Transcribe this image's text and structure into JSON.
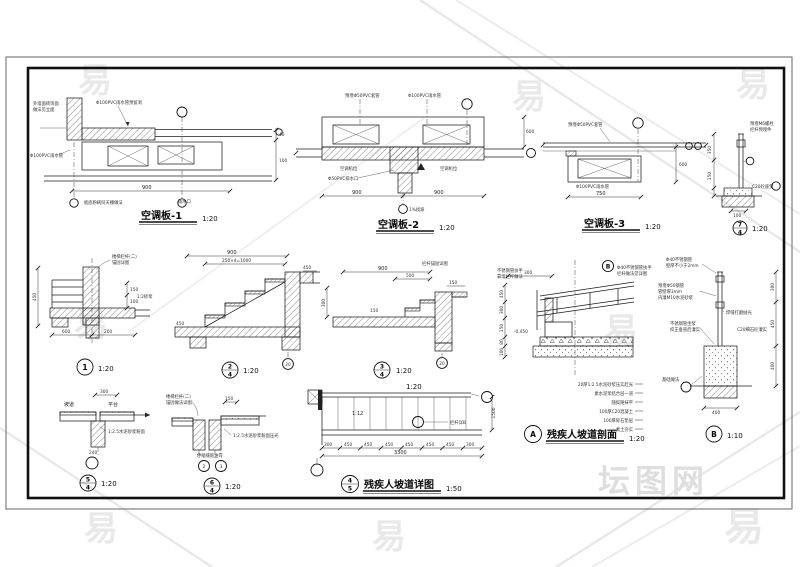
{
  "watermark": {
    "glyph": "易",
    "brand": "坛图网"
  },
  "ac1": {
    "title": "空调板-1",
    "scale": "1:20",
    "dim_total": "900",
    "dim_r1": "40",
    "dim_r2": "100",
    "a_wall1": "外墙面砖饰面",
    "a_wall2": "做法见立面",
    "a_pipe_top": "Φ100PVC雨水管预留洞",
    "a_pipe_left": "Φ100PVC雨水管",
    "a_bottom": "板底粉刷同天棚做法",
    "a_drain": "雨水口"
  },
  "ac2": {
    "title": "空调板-2",
    "scale": "1:20",
    "dim_l": "900",
    "dim_r": "900",
    "dim_side": "600",
    "a_sleeve": "预埋Φ50PVC套管",
    "a_pipe": "Φ100PVC雨水管",
    "a_unit1": "空调机位",
    "a_unit2": "空调机位",
    "a_drain": "Φ50PVC排水口",
    "a_slope": "1%找坡"
  },
  "ac3": {
    "title": "空调板-3",
    "scale": "1:20",
    "dim_total": "750",
    "dim_side": "600",
    "a_sleeve": "预埋Φ50PVC套管",
    "a_pipe": "Φ100PVC雨水管"
  },
  "post": {
    "scale": "1:20",
    "num_top": "7",
    "num_bot": "4",
    "a1": "预埋M6螺栓",
    "a2": "栏杆预埋件",
    "a3": "C20砼座浆",
    "dim1": "350",
    "dim2": "150",
    "dim3": "100"
  },
  "d1": {
    "num": "1",
    "scale": "1:20",
    "a1": "楼梯栏杆(二)",
    "a2": "锚固详图",
    "a3": "1:2砂浆",
    "dim_b1": "600",
    "dim_b2": "200",
    "dim_r1": "150",
    "dim_r2": "100",
    "dim_l": "450"
  },
  "d2": {
    "num_top": "2",
    "num_bot": "4",
    "scale": "1:20",
    "ref": "20",
    "dim1": "900",
    "dim2": "250×4=1000",
    "dim3": "450",
    "dim4": "450"
  },
  "d3": {
    "num_top": "3",
    "num_bot": "4",
    "scale": "1:20",
    "ref": "20",
    "a1": "栏杆锚固详图",
    "dim1": "900",
    "dim2": "500",
    "dim3": "150",
    "dim4": "300",
    "dim5": "150"
  },
  "dA": {
    "letter": "A",
    "title": "残疾人坡道剖面",
    "scale": "1:20",
    "ref": "B",
    "a1": "不锈钢管扶手",
    "a2": "靠墙栏杆做法",
    "a3": "Φ40不锈钢管扶手",
    "a4": "栏杆做法见详图",
    "elev": "-0.450",
    "dim_top": "300",
    "dims": [
      "450",
      "300",
      "150",
      "80",
      "100"
    ],
    "layers": [
      "20厚1:2.5水泥砂浆压实赶光",
      "素水泥浆结合层一道",
      "随捣随抹平",
      "100厚C20混凝土",
      "100厚碎石垫层",
      "素土夯实"
    ]
  },
  "dB": {
    "letter": "B",
    "scale": "1:10",
    "a1": "Φ40不锈钢管",
    "a2": "壁厚不小于2mm",
    "a3": "预埋Φ50钢管",
    "a4": "管壁厚3mm",
    "a5": "内灌M10水泥砂浆",
    "a6": "不锈钢管坐浆",
    "a7": "校正垂直后灌实",
    "a8": "焊缝打磨抛光",
    "a9": "C20细石砼灌实",
    "a10": "基础做法",
    "dim_b": "400",
    "dims": [
      "300",
      "450",
      "400"
    ]
  },
  "d5": {
    "num_top": "5",
    "num_bot": "4",
    "scale": "1:20",
    "l1": "坡道",
    "l2": "平台",
    "a1": "1:2.5水泥砂浆粉面",
    "dim": "300",
    "dim_b": "240"
  },
  "d6": {
    "num_top": "6",
    "num_bot": "4",
    "scale": "1:20",
    "a1": "楼梯栏杆(二)",
    "a2": "锚固做法详图",
    "a3": "1:2.5水泥砂浆粉面压光",
    "a4": "伸缩缝嵌油膏",
    "dim": "150",
    "ref1": "2",
    "ref2": "3"
  },
  "plan": {
    "num_top": "4",
    "num_bot": "5",
    "title": "残疾人坡道详图",
    "scale": "1:50",
    "slope_label": "1:20",
    "slope": "1:12",
    "a1": "栏杆详B",
    "segs": [
      "300",
      "450",
      "450",
      "450",
      "450",
      "450",
      "450",
      "300"
    ],
    "total": "3300",
    "width": "1500"
  }
}
